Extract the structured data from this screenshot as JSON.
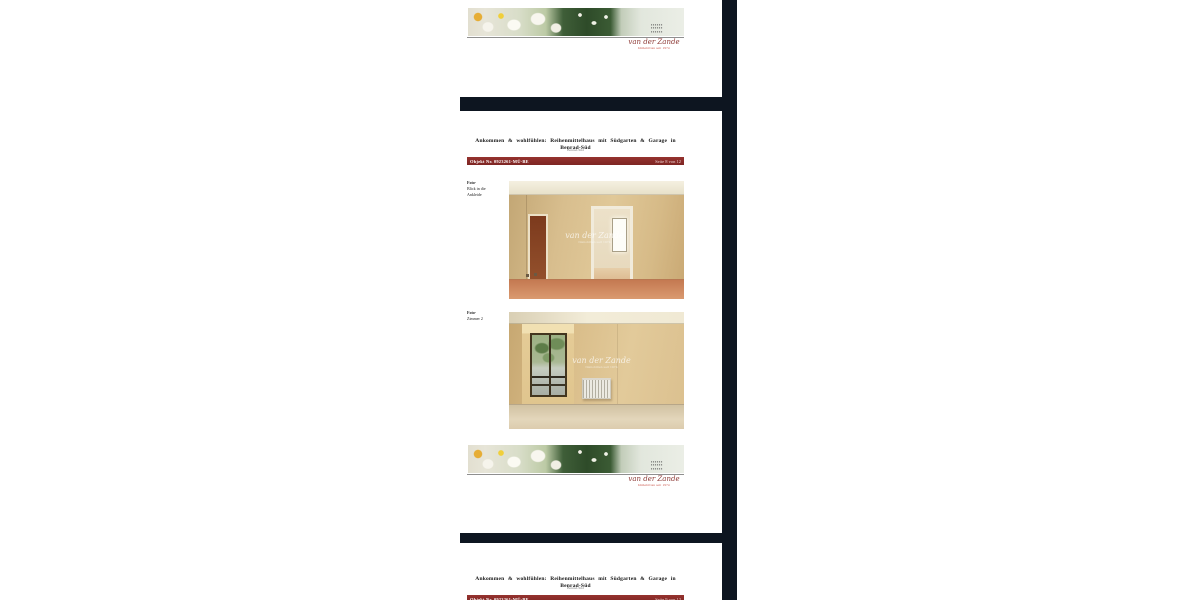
{
  "brand": {
    "script": "van der Zande",
    "subline": "Immobilien seit 1974",
    "emblem_glyph": "▪▪▪▪▪▪\n▪▪▪▪▪▪\n▪▪▪▪▪▪"
  },
  "page_current": {
    "title": "Ankommen & wohlfühlen: Reihenmittelhaus mit Südgarten & Garage in Benrad-Süd",
    "subtitle": "Benrad-Süd",
    "object_label": "Objekt Nr. 0923261-MÜ-BE",
    "page_label": "Seite 8 von 12",
    "caption1": [
      "Foto-",
      "Blick in die",
      "Ankleide"
    ],
    "caption2": [
      "Foto-",
      "Zimmer 2"
    ],
    "watermark": "van der Zande"
  },
  "page_next": {
    "title": "Ankommen & wohlfühlen: Reihenmittelhaus mit Südgarten & Garage in Benrad-Süd",
    "subtitle": "Benrad-Süd",
    "object_label": "Objekt Nr. 0923261-MÜ-BE",
    "page_label": "Seite 9 von 12"
  },
  "colors": {
    "accent_bar_red": "#8b2e2c",
    "brand_red": "#8d3a36",
    "viewer_background": "#0d1520"
  }
}
